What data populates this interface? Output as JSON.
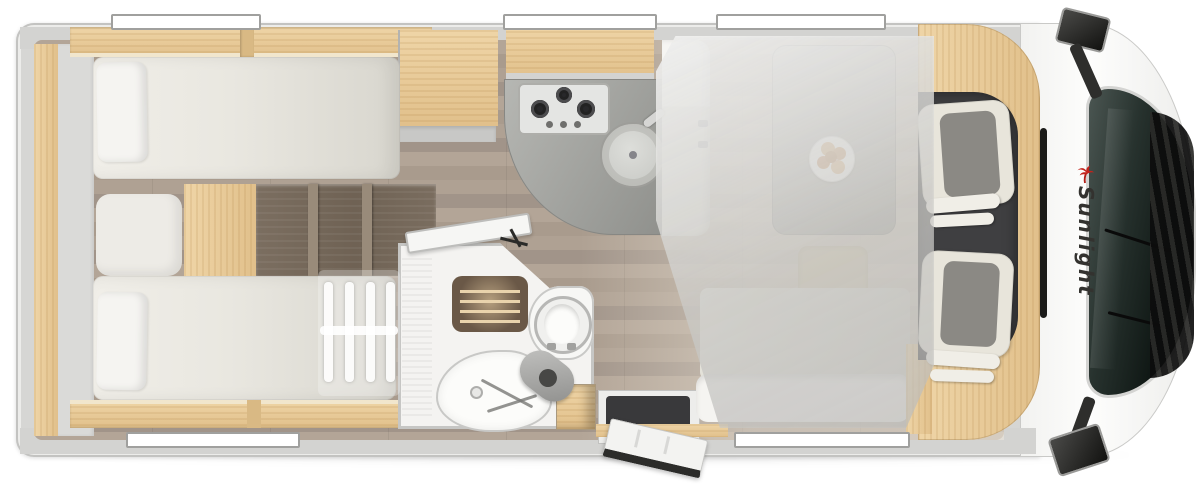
{
  "meta": {
    "view": "motorhome floor plan, top-down 3D render",
    "vehicle_type": "semi-integrated motorhome"
  },
  "brand": {
    "name": "Sunlight",
    "logo_icon": "palm-tree-icon",
    "logo_color": "#c3231c",
    "text_color": "#33322f"
  },
  "areas": [
    {
      "name": "rear-bedroom",
      "features": [
        "twin single beds",
        "two pillows",
        "center steps with dividers",
        "overhead cabinets",
        "wood wall lining"
      ]
    },
    {
      "name": "wardrobe",
      "features": [
        "tall cabinet between bed and kitchen"
      ]
    },
    {
      "name": "kitchen",
      "features": [
        "3-burner gas hob with 3 knobs",
        "round sink with faucet",
        "curved gray worktop",
        "overhead lockers"
      ]
    },
    {
      "name": "bathroom",
      "features": [
        "shower with wooden grate",
        "toilet",
        "washbasin with mixer",
        "small wood cabinet",
        "door shown open"
      ]
    },
    {
      "name": "dinette",
      "features": [
        "side bench",
        "pedestal table",
        "plate with bread rolls",
        "bench seat with tan cushion",
        "drop-down bed shown translucent",
        "bunk ladder shown translucent"
      ]
    },
    {
      "name": "entrance",
      "features": [
        "entry step well",
        "entry door shown open"
      ]
    },
    {
      "name": "cab",
      "features": [
        "two swivel captain seats with checkered cushions",
        "dark cab floor",
        "curved wood dash surround",
        "windshield",
        "front grille",
        "two exterior mirrors",
        "brand decal on hood"
      ]
    }
  ],
  "windows": {
    "top_count": 3,
    "bottom_count": 2
  },
  "colors": {
    "body_white": "#fbfbfa",
    "wall_gray": "#d4d4d2",
    "wood_light": "#e9cb9b",
    "wood_dark": "#77695c",
    "floor_planks": "#ab9d8f",
    "mattress": "#ebe9e2",
    "worktop": "#a3a4a0",
    "cab_floor": "#3f3f41",
    "seat_cream": "#e8e5db",
    "seat_gray": "#8b8984",
    "glass_dark": "#18201d",
    "brand_red": "#c3231c"
  }
}
